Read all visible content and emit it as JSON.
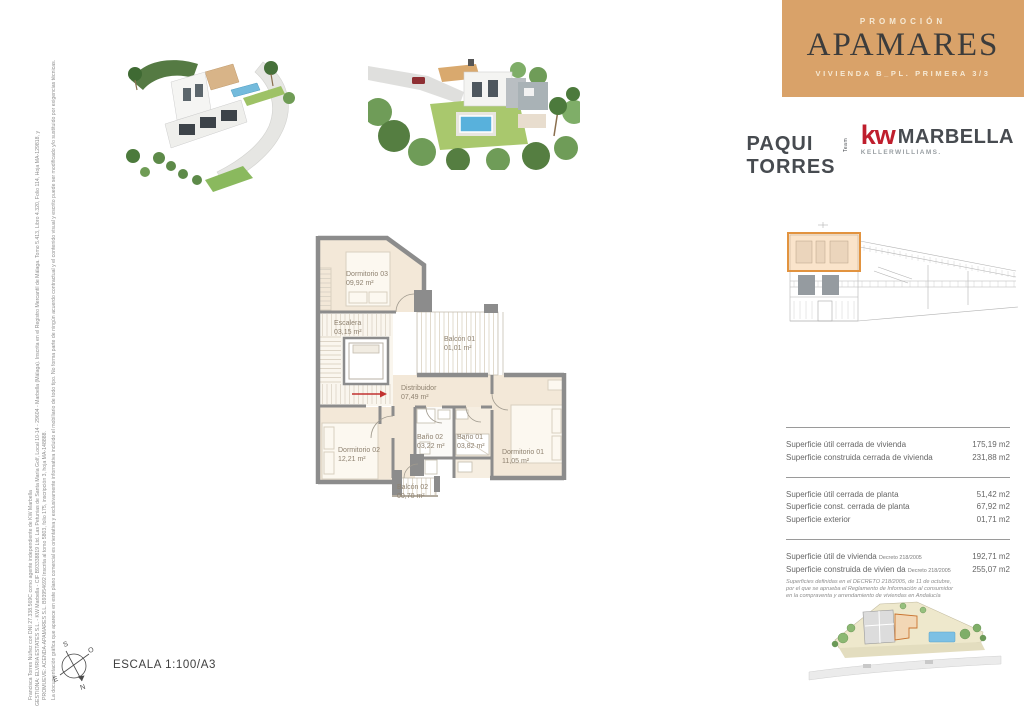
{
  "header": {
    "kicker": "PROMOCIÓN",
    "title": "APAMARES",
    "subtitle": "VIVIENDA B_PL. PRIMERA 3/3",
    "bg_color": "#d9a269"
  },
  "agency": {
    "name": "PAQUI TORRES",
    "team": "Team",
    "kw": "kw",
    "brand": "MARBELLA",
    "sub_brand": "KELLERWILLIAMS.",
    "accent_color": "#bf1e2d"
  },
  "plan": {
    "wall_color": "#8c8c8c",
    "floor_color": "#f3e8d8",
    "rooms": [
      {
        "name": "Dormitorio 03",
        "area": "09,92 m²"
      },
      {
        "name": "Escalera",
        "area": "03,15 m²"
      },
      {
        "name": "Balcón 01",
        "area": "01,01 m²"
      },
      {
        "name": "Distribuidor",
        "area": "07,49 m²"
      },
      {
        "name": "Dormitorio 02",
        "area": "12,21 m²"
      },
      {
        "name": "Baño 02",
        "area": "03,22 m²"
      },
      {
        "name": "Baño 01",
        "area": "03,82 m²"
      },
      {
        "name": "Dormitorio 01",
        "area": "11,05 m²"
      },
      {
        "name": "Balcón 02",
        "area": "00,70 m²"
      }
    ]
  },
  "surfaces": {
    "group1": [
      {
        "label": "Superficie útil cerrada de vivienda",
        "value": "175,19 m2"
      },
      {
        "label": "Superficie construida cerrada de vivienda",
        "value": "231,88 m2"
      }
    ],
    "group2": [
      {
        "label": "Superficie útil cerrada de planta",
        "value": "51,42 m2"
      },
      {
        "label": "Superficie const. cerrada de planta",
        "value": "67,92 m2"
      },
      {
        "label": "Superficie exterior",
        "value": "01,71 m2"
      }
    ],
    "group3": [
      {
        "label": "Superficie útil de vivienda",
        "decree": "Decreto 218/2005",
        "value": "192,71 m2"
      },
      {
        "label": "Superficie construida de vivien da",
        "decree": "Decreto 218/2005",
        "value": "255,07 m2"
      }
    ],
    "footnote": "Superficies definidas en el DECRETO 218/2005, de 11 de octubre, por el que se aprueba el Reglamento de Información al consumidor en la compraventa y arrendamiento de viviendas en Andalucía"
  },
  "footer": {
    "scale_label": "ESCALA 1:100/A3",
    "compass": {
      "n": "N",
      "s": "S",
      "e": "E",
      "o": "O"
    }
  },
  "legal": {
    "line1": "La documentación gráfica que aparece en este plano comercial es orientativa y exclusivamente informativa incluido el mobiliario de todo tipo. No forma parte de ningún acuerdo contractual y el contenido visual y escrito puede ser modificado y/o sustituido por exigencias técnicas.",
    "line2": "PROMUEVE: ACENDA-APAMARES S.L. B93954692 Inscrita al tomo 5803, folio 175, inscripción 3, hoja MA-148888.",
    "line3": "GESTIONA: ELVIRIA ESTATES S.L. - KW Marbella - CIF B93338819 Ltd. Las Petunias de Santa María Golf, Local 10-14 - 29604 - Marbella (Málaga). Inscrita en el Registro Mercantil de Málaga. Tomo 5.413, Libro 4.320, Folio 114, Hoja MA-129818, y",
    "line4": "Francisca Torres Núñez con DNI 27.338.569C como agente independiente de KW Marbella"
  }
}
